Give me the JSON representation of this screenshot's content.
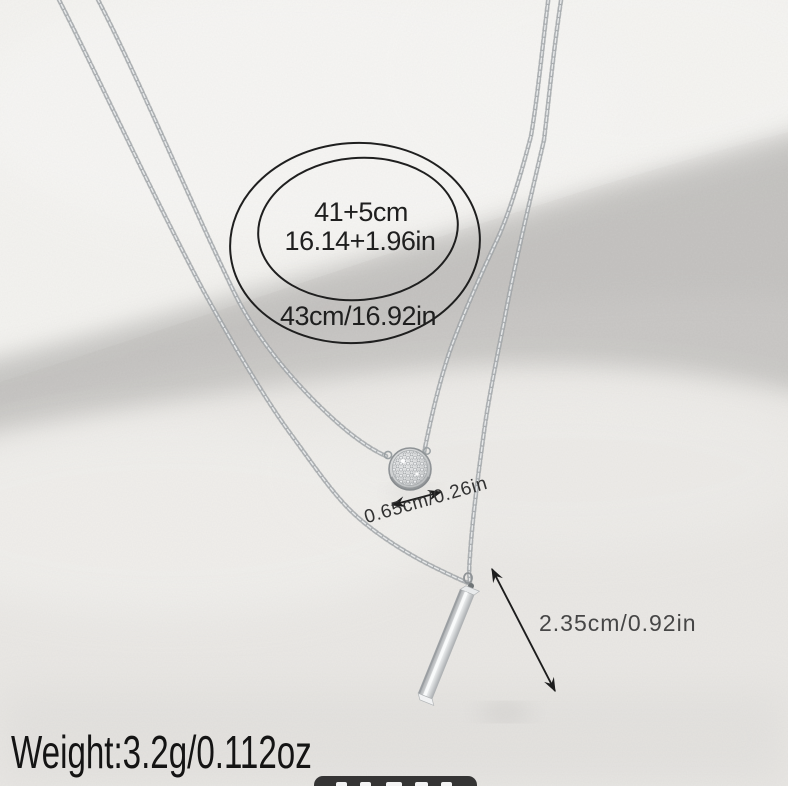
{
  "annotations": {
    "necklace_length": {
      "line1": "41+5cm",
      "line2": "16.14+1.96in",
      "line3": "43cm/16.92in"
    },
    "disc_pendant_size": "0.65cm/0.26in",
    "bar_pendant_size": "2.35cm/0.92in",
    "weight": "Weight:3.2g/0.112oz"
  },
  "icons": {
    "disc_measure_arrow": "double-headed-arrow",
    "bar_measure_arrow": "double-headed-arrow"
  },
  "colors": {
    "bg": "#eceae7",
    "roll-light": "#f4f3f0",
    "surface": "#e9e8e5",
    "shadow-band": "#a7a6a4",
    "chain-base": "#a9adb0",
    "chain-highlight": "#e6e8e9",
    "chain-dark": "#878c8f",
    "metal-light": "#f3f5f6",
    "metal-mid": "#c6c8ca",
    "metal-dark": "#a0a4a7",
    "annotation-ink": "#1f1f1f",
    "measure-ink": "#3e3e3e",
    "watermark-bg": "#2e2e2e"
  }
}
